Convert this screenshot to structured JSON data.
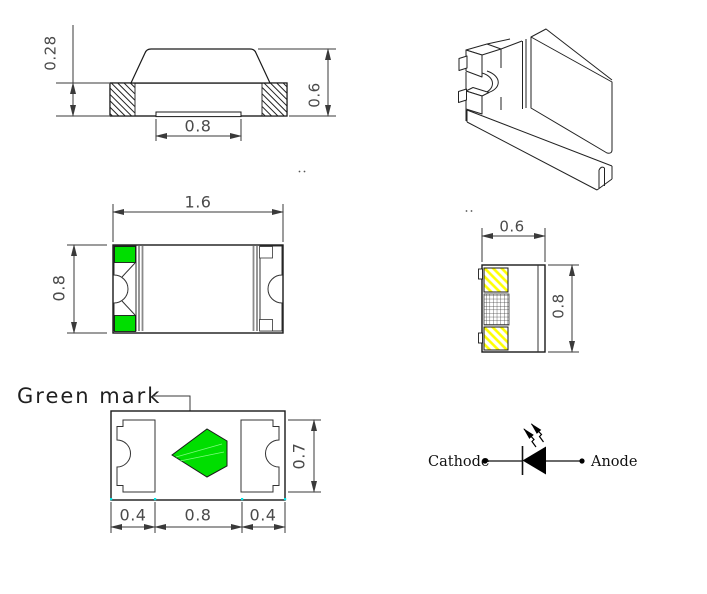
{
  "colors": {
    "green": "#00DE00",
    "yellow": "#FFFF00",
    "cyan": "#00E6E6"
  },
  "side_view": {
    "dim_base_height": "0.28",
    "dim_total_height": "0.6",
    "dim_recess_width": "0.8"
  },
  "top_view": {
    "dim_length": "1.6",
    "dim_width": "0.8"
  },
  "end_view": {
    "dim_width": "0.6",
    "dim_height": "0.8"
  },
  "bottom_view": {
    "green_mark_label": "Green mark",
    "dim_left_pad": "0.4",
    "dim_center": "0.8",
    "dim_right_pad": "0.4",
    "dim_pad_height": "0.7"
  },
  "circuit_symbol": {
    "cathode_label": "Cathode",
    "anode_label": "Anode"
  }
}
